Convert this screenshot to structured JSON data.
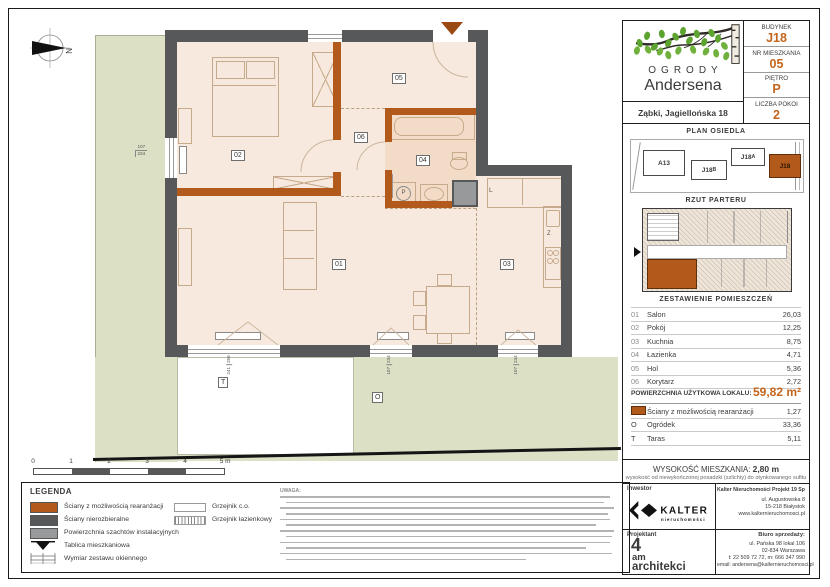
{
  "colors": {
    "accent": "#c4651c",
    "wall_dark": "#57585a",
    "wall_orange": "#b15a1b",
    "garden_green": "#dce0c5",
    "floor_beige": "#f7e9de",
    "bath_beige": "#f2dcc7",
    "shaft_gray": "#97999b"
  },
  "header": {
    "logo_line1": "OGRODY",
    "logo_line2": "Andersena",
    "address": "Ząbki, Jagiellońska 18",
    "fields": [
      {
        "label": "BUDYNEK",
        "value": "J18"
      },
      {
        "label": "NR MIESZKANIA",
        "value": "05"
      },
      {
        "label": "PIĘTRO",
        "value": "P"
      },
      {
        "label": "LICZBA POKOI",
        "value": "2"
      }
    ]
  },
  "estate_plan": {
    "title": "PLAN OSIEDLA",
    "buildings": [
      {
        "base": "A13",
        "suffix": ""
      },
      {
        "base": "J18",
        "suffix": "B"
      },
      {
        "base": "J18",
        "suffix": "A"
      },
      {
        "base": "J18",
        "suffix": ""
      }
    ]
  },
  "ground_plan": {
    "title": "RZUT PARTERU"
  },
  "rooms": {
    "title": "ZESTAWIENIE POMIESZCZEŃ",
    "rows": [
      {
        "no": "01",
        "name": "Salon",
        "area": "26,03"
      },
      {
        "no": "02",
        "name": "Pokój",
        "area": "12,25"
      },
      {
        "no": "03",
        "name": "Kuchnia",
        "area": "8,75"
      },
      {
        "no": "04",
        "name": "Łazienka",
        "area": "4,71"
      },
      {
        "no": "05",
        "name": "Hol",
        "area": "5,36"
      },
      {
        "no": "06",
        "name": "Korytarz",
        "area": "2,72"
      }
    ],
    "total_label": "POWIERZCHNIA UŻYTKOWA LOKALU:",
    "total_value": "59,82 m²",
    "extras": [
      {
        "sym": "",
        "name": "Ściany z możliwością rearanżacji",
        "value": "1,27"
      },
      {
        "sym": "O",
        "name": "Ogródek",
        "value": "33,36"
      },
      {
        "sym": "T",
        "name": "Taras",
        "value": "5,11"
      }
    ]
  },
  "height_info": {
    "label": "WYSOKOŚĆ MIESZKANIA:",
    "value": "2,80 m",
    "note": "wysokość od niewykończonej posadzki (szlichty) do otynkowanego sufitu"
  },
  "company": {
    "investor_label": "Inwestor",
    "brand": "KALTER",
    "brand_sub": "nieruchomości",
    "name": "Kalter Nieruchomości Projekt 19 Sp. z o.o.",
    "addr1": "ul. Augustowska 8",
    "addr2": "15-218 Białystok",
    "web": "www.kalternieruchomosci.pl"
  },
  "designer": {
    "label": "Projektant",
    "line1": "4",
    "line2": "am",
    "line3": "architekci"
  },
  "sales": {
    "label": "Biuro sprzedaży:",
    "addr1": "ul. Pańska 98 lokal 106",
    "addr2": "02-834 Warszawa",
    "phone": "t: 22 509 72 72, m: 666 347 990",
    "email": "email: andersena@kalternieruchomosci.pl"
  },
  "legend": {
    "title": "LEGENDA",
    "items": [
      {
        "label": "Ściany z możliwością rearanżacji"
      },
      {
        "label": "Ściany nierozbieralne"
      },
      {
        "label": "Powierzchnia szachtów instalacyjnych"
      },
      {
        "label": "Tablica mieszkaniowa"
      },
      {
        "label": "Wymiar zestawu okiennego"
      }
    ],
    "items2": [
      {
        "label": "Grzejnik c.o."
      },
      {
        "label": "Grzejnik łazienkowy"
      }
    ],
    "notes_heading": "UWAGA:"
  },
  "scalebar": {
    "t0": "0",
    "t1": "1",
    "t2": "2",
    "t3": "3",
    "t4": "4",
    "t5": "5 m"
  },
  "plan": {
    "compass": "N",
    "labels": {
      "salon": "01",
      "pokoj": "02",
      "kuchnia": "03",
      "lazienka": "04",
      "hol": "05",
      "korytarz": "06",
      "taras": "T",
      "ogrodek": "O",
      "pralka": "P",
      "lodowka": "L",
      "zlew": "Z"
    },
    "dims": {
      "left": {
        "a": "107",
        "b": "234"
      },
      "big": {
        "a": "241",
        "b": "256"
      },
      "mid": {
        "a": "107",
        "b": "234"
      },
      "kitchen": {
        "a": "107",
        "b": "234"
      }
    }
  }
}
